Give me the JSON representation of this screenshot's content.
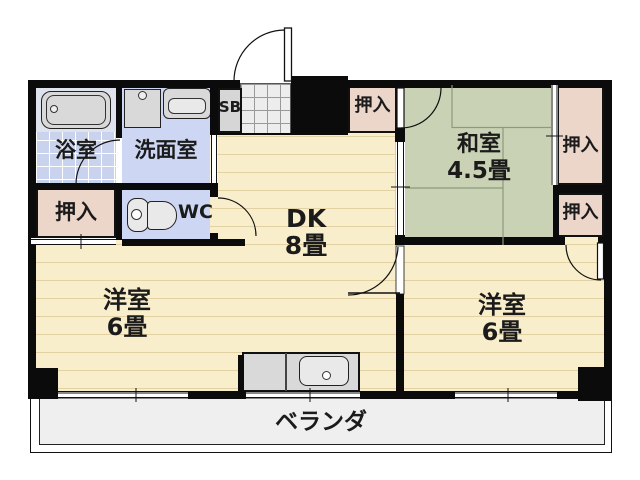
{
  "floorplan": {
    "title": "2DK apartment floor plan",
    "rooms": {
      "bath": {
        "label": "浴室"
      },
      "washroom": {
        "label": "洗面室"
      },
      "wc": {
        "label": "WC"
      },
      "shoe_box": {
        "label": "SB"
      },
      "closet_left": {
        "label": "押入"
      },
      "closet_top": {
        "label": "押入"
      },
      "closet_right_upper": {
        "label": "押入"
      },
      "closet_right_lower": {
        "label": "押入"
      },
      "japanese_room": {
        "label": "和室",
        "size": "4.5畳"
      },
      "dining_kitchen": {
        "label": "DK",
        "size": "8畳"
      },
      "western_room_left": {
        "label": "洋室",
        "size": "6畳"
      },
      "western_room_right": {
        "label": "洋室",
        "size": "6畳"
      },
      "veranda": {
        "label": "ベランダ"
      }
    },
    "colors": {
      "wall": "#0b0b0b",
      "wood_floor": "#f9eecb",
      "wood_stripe": "#e2d1a2",
      "tatami": "#c9d2b5",
      "tatami_line": "#8e9a7c",
      "wet_room": "#cdd6f3",
      "bath_tile": "#c9d3ee",
      "closet": "#ecd5c9",
      "fixture": "#d9d9d9",
      "entry_tile": "#ededed",
      "veranda": "#efefef"
    }
  }
}
